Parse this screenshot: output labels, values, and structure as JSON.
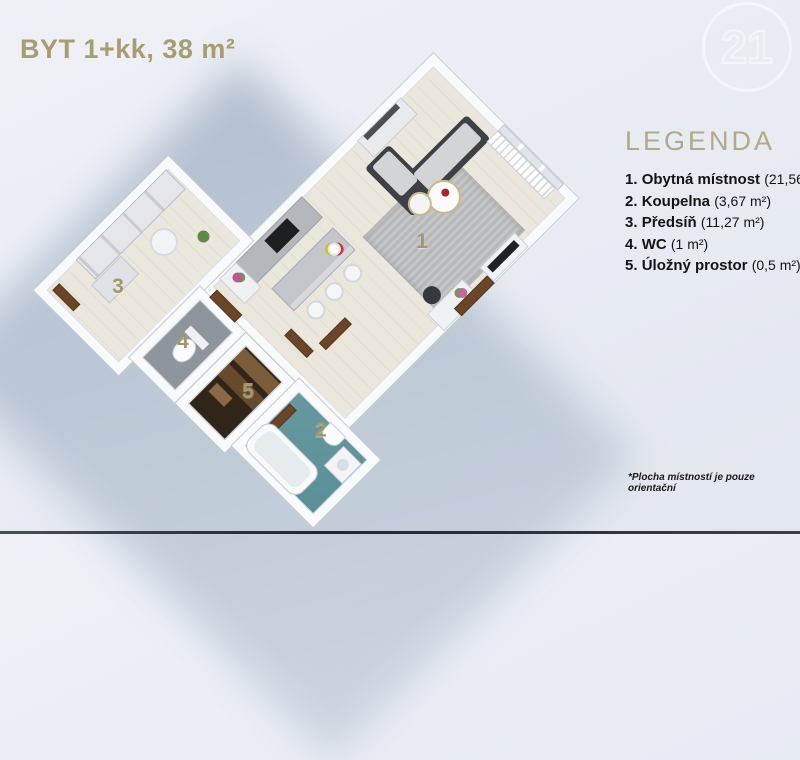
{
  "title": "BYT 1+kk, 38 m²",
  "logo": {
    "text": "21"
  },
  "legend": {
    "heading": "LEGENDA",
    "items": [
      {
        "num": "1.",
        "name": "Obytná místnost",
        "area": "(21,56 m²)"
      },
      {
        "num": "2.",
        "name": "Koupelna",
        "area": "(3,67 m²)"
      },
      {
        "num": "3.",
        "name": "Předsíň",
        "area": "(11,27 m²)"
      },
      {
        "num": "4.",
        "name": "WC",
        "area": "(1 m²)"
      },
      {
        "num": "5.",
        "name": "Úložný prostor",
        "area": "(0,5 m²)"
      }
    ]
  },
  "footnote": "*Plocha místností je pouze orientační",
  "plan": {
    "labels": [
      {
        "number": "1"
      },
      {
        "number": "2"
      },
      {
        "number": "3"
      },
      {
        "number": "4"
      },
      {
        "number": "5"
      }
    ]
  },
  "colors": {
    "accent_gold": "#a89d6f",
    "legend_heading": "#b2a986",
    "shadow_blue": "#b8c4d3",
    "bath_floor_teal": "#5e98a1",
    "storage_floor_brown": "#31251a",
    "sofa_dark": "#3d4145"
  }
}
